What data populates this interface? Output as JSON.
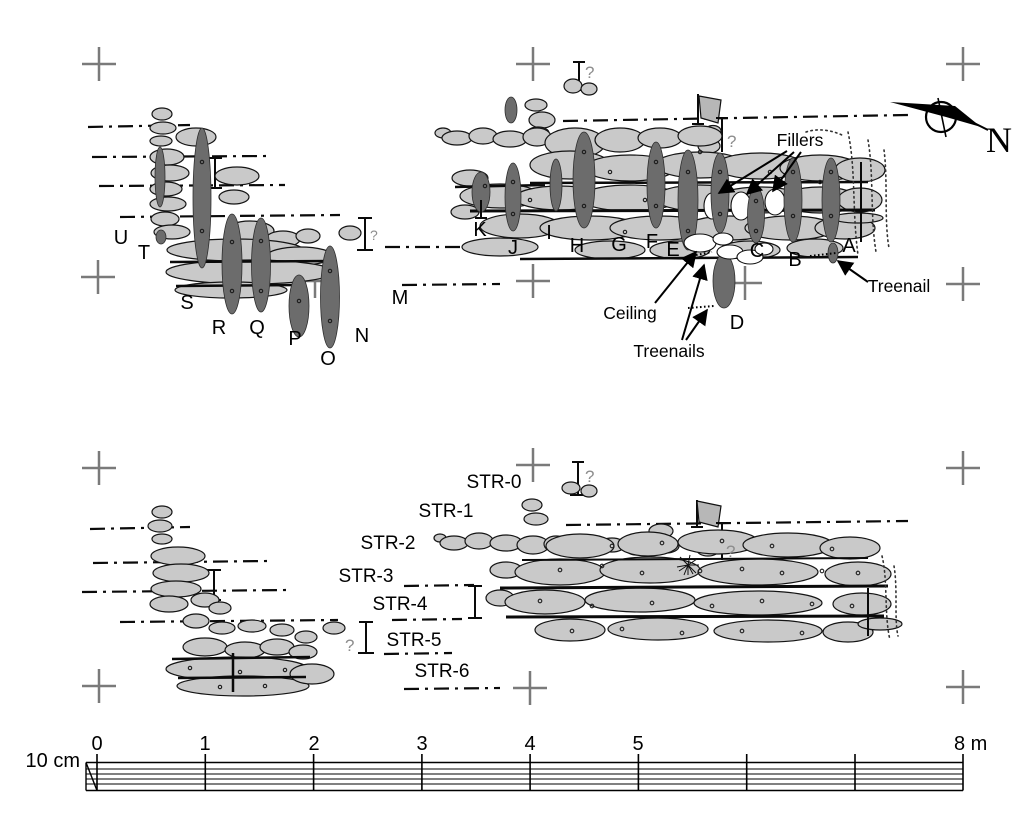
{
  "figure_type": "shipwreck-timber-site-plan",
  "colors": {
    "background": "#ffffff",
    "plank": "#c9c9c9",
    "frame": "#6c6c6c",
    "outline": "#141414",
    "survey_cross": "#7a7a7a",
    "query_gray": "#8d8d8d"
  },
  "upper": {
    "frames": [
      "U",
      "T",
      "S",
      "R",
      "Q",
      "P",
      "O",
      "N",
      "M",
      "K",
      "J",
      "I",
      "H",
      "G",
      "F",
      "E",
      "D",
      "C",
      "B",
      "A"
    ],
    "annotations": {
      "fillers": "Fillers",
      "ceiling": "Ceiling",
      "treenails": "Treenails",
      "treenail": "Treenail"
    }
  },
  "lower": {
    "strata": [
      "STR-0",
      "STR-1",
      "STR-2",
      "STR-3",
      "STR-4",
      "STR-5",
      "STR-6"
    ]
  },
  "symbols": {
    "question_mark": "?",
    "north": "N"
  },
  "scale_bar": {
    "side_label": "10 cm",
    "tick_labels": [
      "0",
      "1",
      "2",
      "3",
      "4",
      "5"
    ],
    "end_label": "8 m"
  }
}
